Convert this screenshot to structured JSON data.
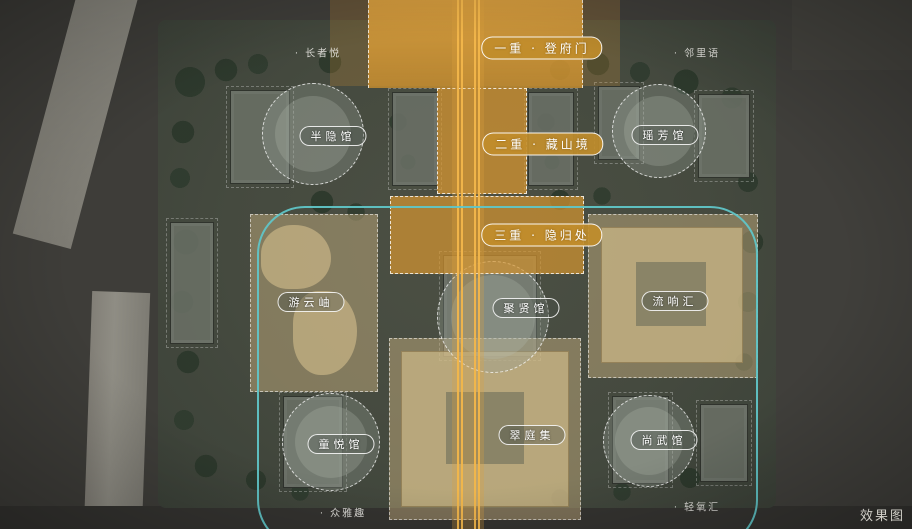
{
  "colors": {
    "accent_orange": "#d89a36",
    "axis_line": "#f2b64b",
    "teal_outline": "#5ec6c8",
    "tan_zone": "#c6b082",
    "label_text": "#ffffff"
  },
  "axis_zones": [
    {
      "label": "一重 · 登府门"
    },
    {
      "label": "二重 · 藏山境"
    },
    {
      "label": "三重 · 隐归处"
    }
  ],
  "venues": [
    {
      "name": "半隐馆"
    },
    {
      "name": "瑶芳馆"
    },
    {
      "name": "游云岫"
    },
    {
      "name": "聚贤馆"
    },
    {
      "name": "流响汇"
    },
    {
      "name": "童悦馆"
    },
    {
      "name": "翠庭集"
    },
    {
      "name": "尚武馆"
    }
  ],
  "poi_labels": [
    {
      "text": "· 长者悦"
    },
    {
      "text": "· 邻里语"
    },
    {
      "text": "· 众雅趣"
    },
    {
      "text": "· 轻氧汇"
    }
  ],
  "watermark": "效果图"
}
